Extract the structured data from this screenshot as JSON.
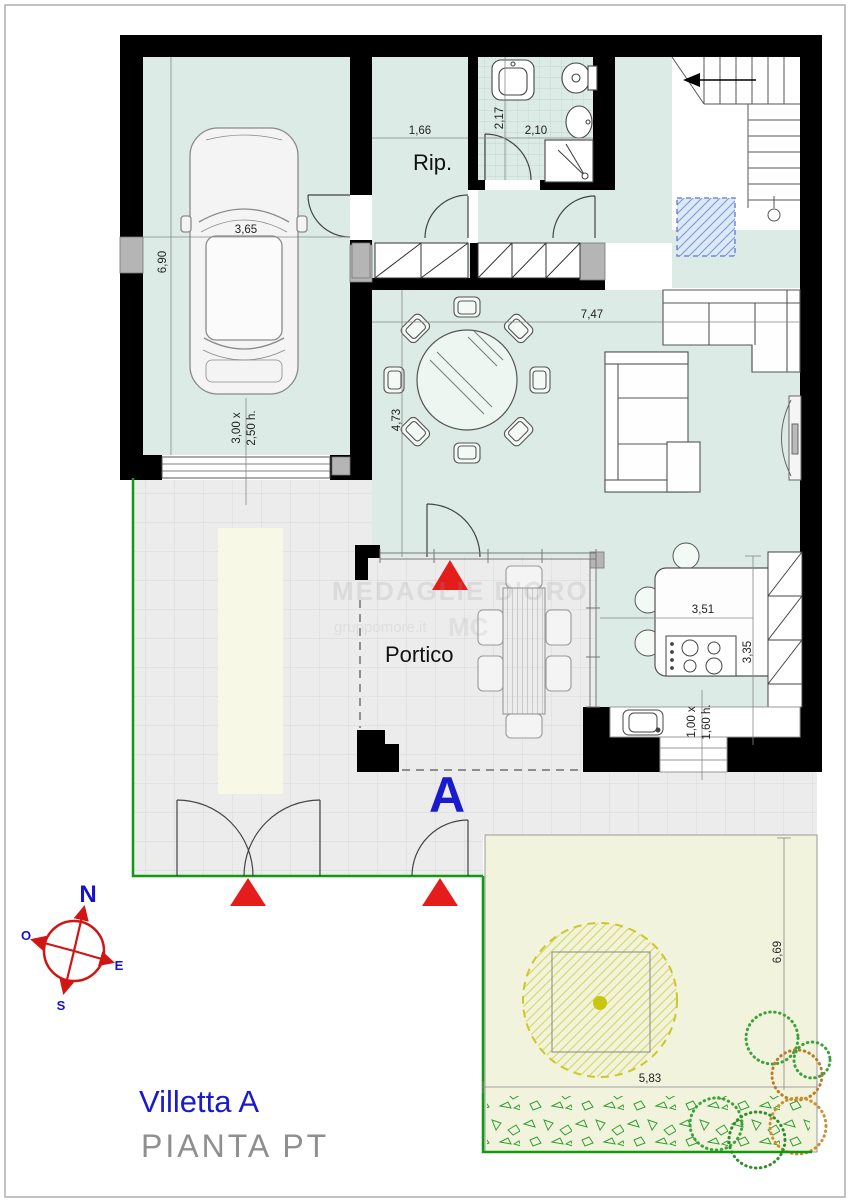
{
  "title": {
    "name": "Villetta A",
    "subtitle": "PIANTA  PT"
  },
  "plan_letter": "A",
  "rooms": {
    "storage": "Rip.",
    "portico": "Portico"
  },
  "dims": {
    "garage_h": "6,90",
    "garage_w": "3,65",
    "garage_door_w": "3,00 x",
    "garage_door_h": "2,50 h.",
    "storage_w": "1,66",
    "bath_h": "2,17",
    "bath_w": "2,10",
    "living_w": "7,47",
    "living_h": "4,73",
    "kitchen_w": "3,51",
    "kitchen_h": "3,35",
    "kitchen_window_w": "1,00 x",
    "kitchen_window_h": "1,60 h.",
    "garden_h": "6,69",
    "garden_w": "5,83"
  },
  "compass": {
    "north": "N",
    "south": "S",
    "east": "E",
    "west": "O"
  },
  "watermark": {
    "line1": "MEDAGLIE D'ORO",
    "line2": "gruppomore.it",
    "line3": "MC"
  },
  "colors": {
    "floor_mint": "#dcebe5",
    "tile_gray": "#ececec",
    "garden_yellow": "#f2f3dd",
    "boundary_green": "#0f9a0f",
    "marker_red": "#e51c1c",
    "accent_blue": "#1a1ace",
    "subtitle_gray": "#8f8f8f"
  }
}
